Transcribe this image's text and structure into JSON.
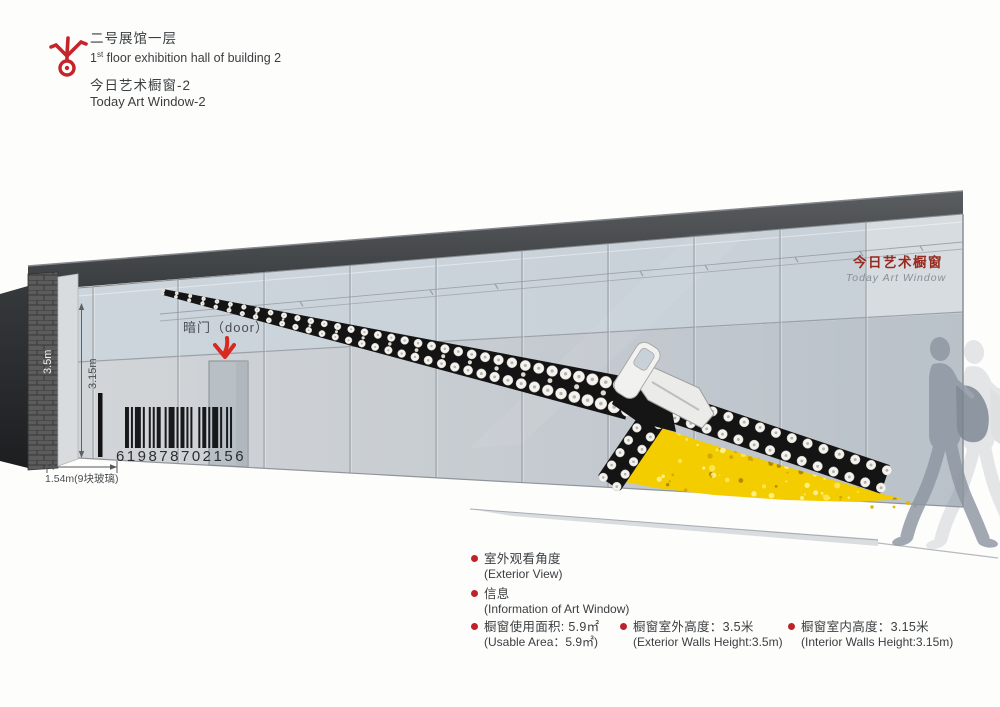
{
  "header": {
    "title_zh": "二号展馆一层",
    "title_en_num": "1",
    "title_en_sup": "st",
    "title_en_rest": " floor exhibition hall of building 2",
    "subtitle_zh": "今日艺术橱窗-2",
    "subtitle_en": "Today Art Window-2"
  },
  "drawing": {
    "sign_zh": "今日艺术橱窗",
    "sign_en": "Today Art Window",
    "door_label": "暗门（door）",
    "barcode_number": "619878702156",
    "dim_exterior_height": "3.5m",
    "dim_interior_height": "3.15m",
    "dim_glass_width": "1.54m(9块玻璃)"
  },
  "notes": [
    {
      "zh": "室外观看角度",
      "en": "(Exterior View)"
    },
    {
      "zh": "信息",
      "en": "(Information of Art Window)"
    },
    {
      "zh": "橱窗使用面积: 5.9㎡",
      "en": "(Usable Area：5.9㎡)"
    },
    {
      "zh": "橱窗室外高度：3.5米",
      "en": "(Exterior Walls Height:3.5m)"
    },
    {
      "zh": "橱窗室内高度：3.15米",
      "en": "(Interior Walls Height:3.15m)"
    }
  ],
  "colors": {
    "accent_red": "#c5242b",
    "sign_red": "#97291f",
    "zipper_yellow": "#f3cd00",
    "roof_dark": "#3c3f42"
  }
}
